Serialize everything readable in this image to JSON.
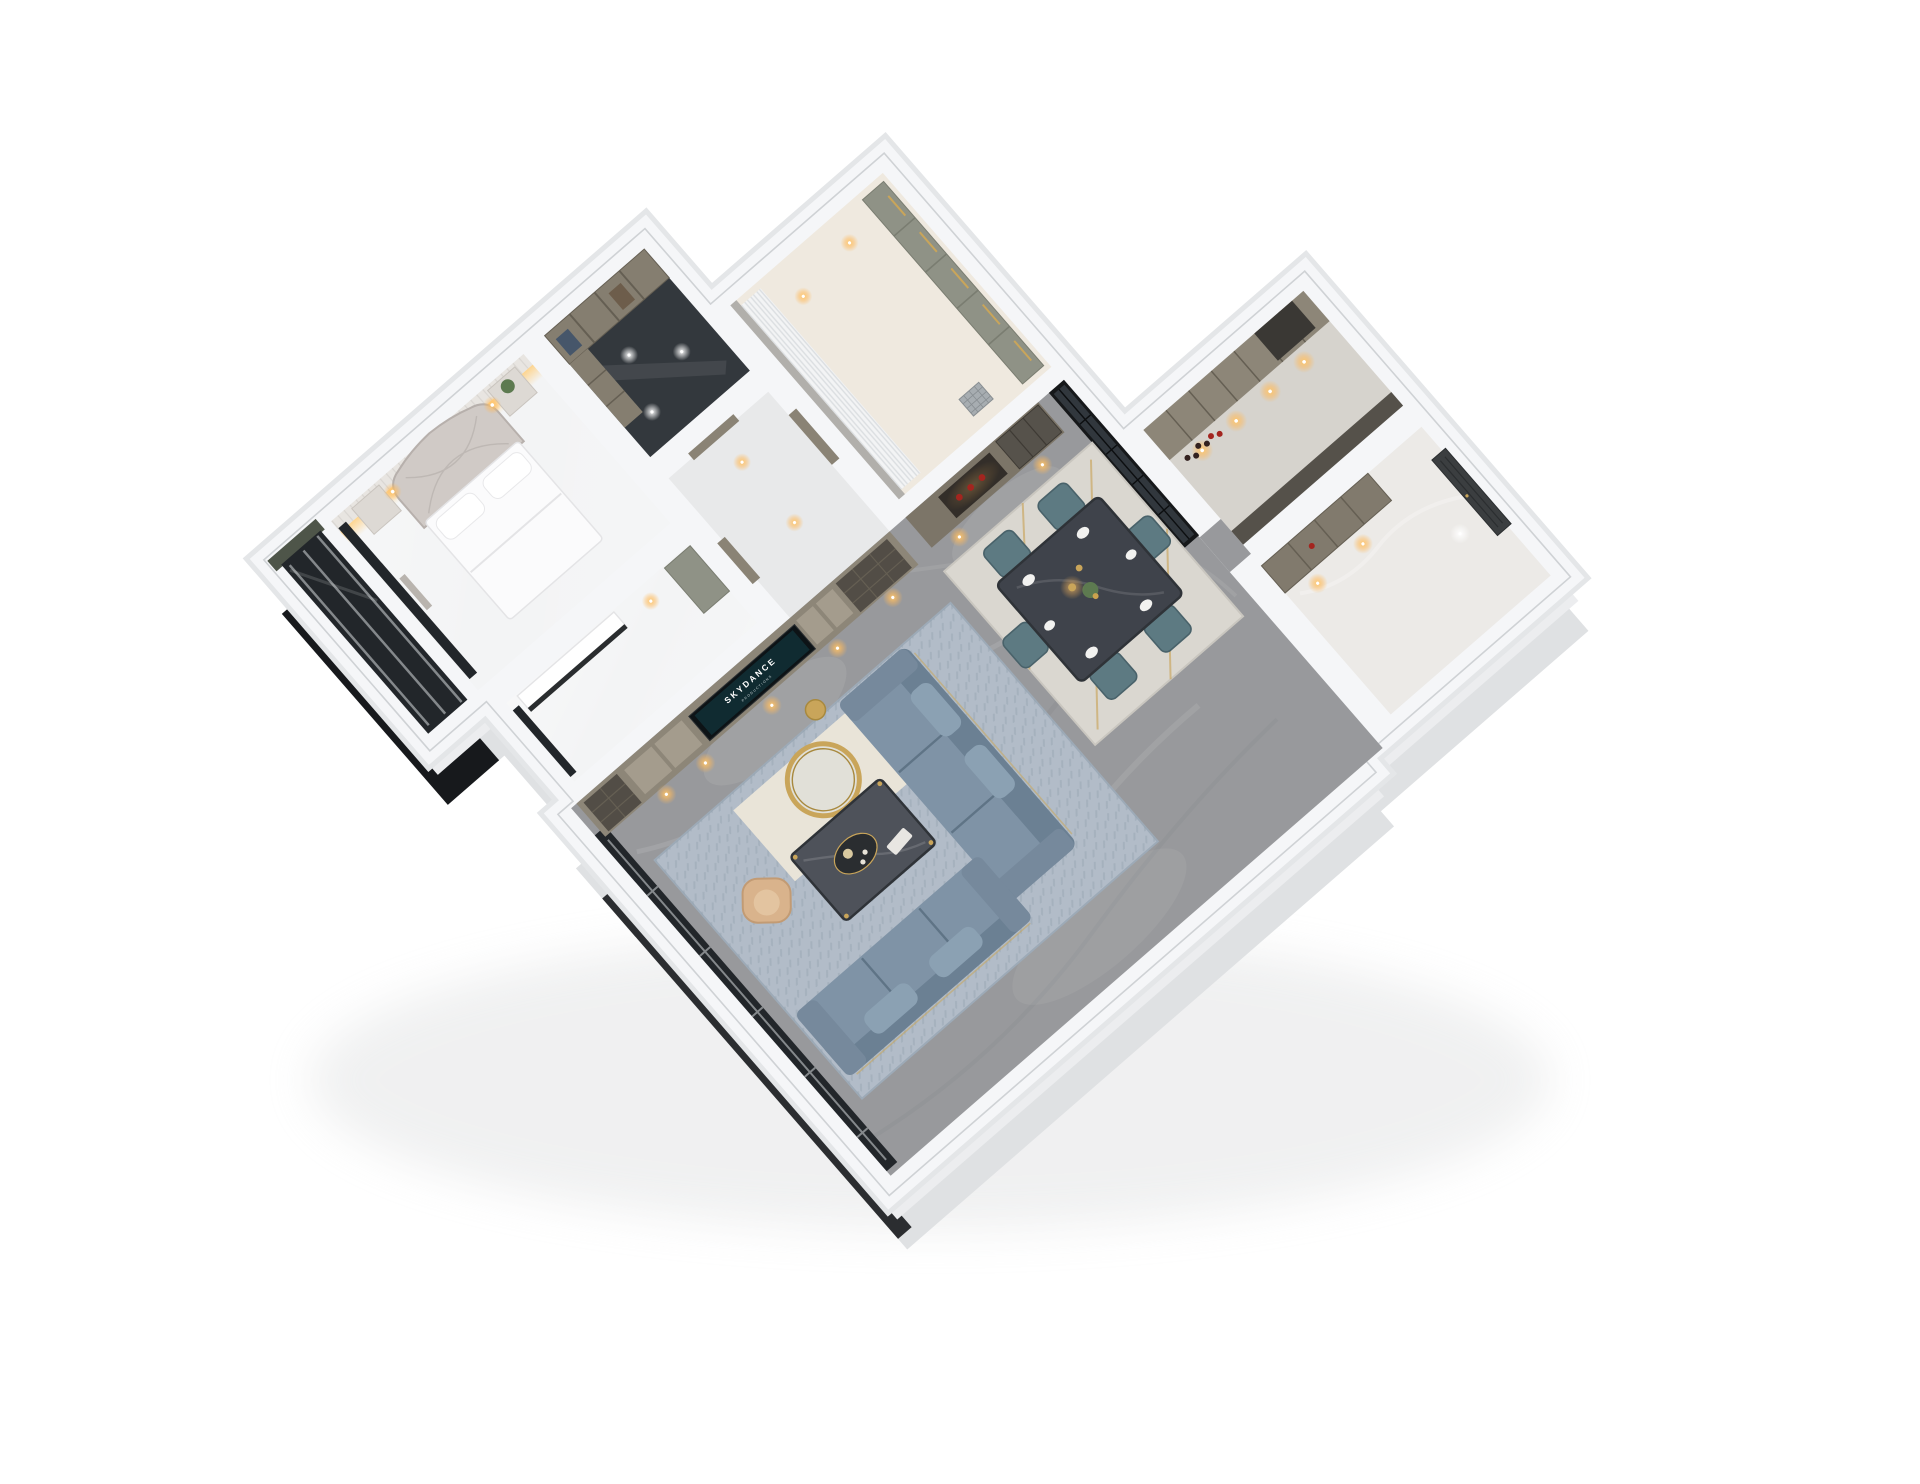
{
  "scene": {
    "type": "3d-dollhouse-floorplan-render",
    "background": "white",
    "tv": {
      "brand": "SKYDANCE",
      "brand_sub": "PRODUCTIONS"
    },
    "rooms": [
      "master-bedroom",
      "bedroom-balcony",
      "walk-in-closet",
      "corridor",
      "dressing-room",
      "kitchen",
      "entry-foyer",
      "study",
      "living-room",
      "dining-area"
    ],
    "furnishings": [
      "upholstered-bed",
      "nightstands",
      "wardrobe-shelving",
      "sheer-curtains",
      "tv-media-wall",
      "l-shaped-blue-sofas",
      "marble-coffee-table",
      "gold-ring-mirror",
      "gold-stool",
      "tan-accent-chair",
      "dining-table-six-teal-chairs",
      "pendant-light",
      "display-sideboard",
      "glass-partition",
      "kitchen-cabinets-wine-bottles",
      "charcoal-entry-door",
      "floor-to-ceiling-windows",
      "floor-drain-grate"
    ]
  },
  "palette": {
    "bg": "#ffffff",
    "shadow": "#c9ccce",
    "slabDeep": "#dfe1e3",
    "slabMid": "#ecedef",
    "slabGlassDark": "#17191c",
    "wallFill": "#f5f6f8",
    "wallShade": "#e4e6e8",
    "wallLine": "#cfd2d5",
    "floorMarble": "#98999c",
    "floorWhite": "#f3f4f5",
    "floorBeige": "#efe9df",
    "floorKitchen": "#d6d3cd",
    "floorEntry": "#eceae7",
    "floorDark": "#33383d",
    "floorCorridor": "#e8e9ea",
    "glassDark": "#22262a",
    "glassFrame": "#84888b",
    "cabinet": "#8d8678",
    "cabinetFace": "#a49c8d",
    "cabinetOpen": "#524d46",
    "sideboard": "#7c7568",
    "nicheDark": "#332e29",
    "red": "#a3251f",
    "tvBezel": "#0d1316",
    "tvScreen": "#102b31",
    "sofa": "#7f93a6",
    "sofaDark": "#6b8093",
    "sofaLine": "#5f7486",
    "sofaPillow": "#8ba1b3",
    "gold": "#c9a55a",
    "goldDark": "#a8893e",
    "tableTop": "#4e525a",
    "tableEdge": "#2f3338",
    "tray": "#2a2d30",
    "rugLiving": "#b2bcc8",
    "rugBorder": "#9daab7",
    "rugCream": "#e9e4d8",
    "rugDining": "#dad7d0",
    "rugDiningEdge": "#c9c6bf",
    "teal": "#5d7a82",
    "tealEdge": "#49626a",
    "tan": "#d9b38c",
    "tanEdge": "#c29b74",
    "diningTop": "#3f434b",
    "doorTaupe": "#8a8375",
    "doorDark": "#3b3e40",
    "curtain": "#f3f4f5",
    "curtainLine": "#dbdee1",
    "wardrobe": "#8f9286",
    "wardrobeLine": "#7a7d71",
    "bedWhite": "#fbfbfc",
    "bedLine": "#e4e4e6",
    "headboard": "#d0cac6",
    "headboardLine": "#b7b0ac",
    "panel": "#e8e5e1",
    "panelLine": "#d9d6d2",
    "warm": "#ffc76a",
    "counterDark": "#55514a",
    "appliance": "#3a3834",
    "plate": "#f2f2f0",
    "green": "#5d7a50",
    "grate": "#a7adb1",
    "grateLine": "#888e92",
    "shelf": "#857e70",
    "shelfLine": "#655f53",
    "clothesA": "#46566a",
    "clothesB": "#6d5d4b",
    "bottle": "#33211f",
    "white": "#ffffff",
    "veinDark": "#75787b"
  }
}
